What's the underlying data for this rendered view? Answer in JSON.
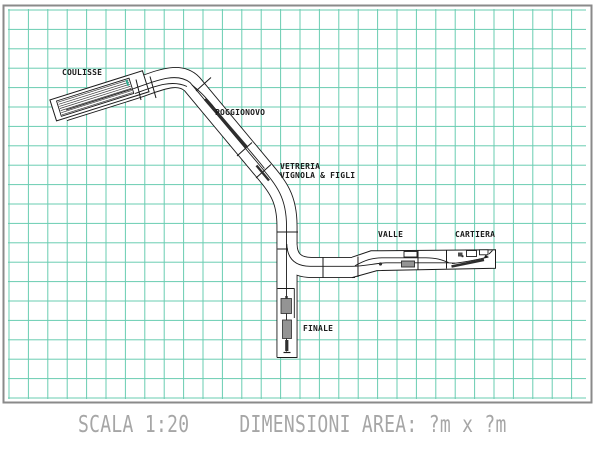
{
  "plan": {
    "type": "model-railway-track-plan",
    "scale": "1:20",
    "stations": {
      "coulisse": "COULISSE",
      "poggionovo": "POGGIONOVO",
      "vetreria_line1": "VETRERIA",
      "vetreria_line2": "VIGNOLA & FIGLI",
      "valle": "VALLE",
      "cartiera": "CARTIERA",
      "finale": "FINALE"
    },
    "caption": {
      "scale_label": "SCALA 1:20",
      "area_label": "DIMENSIONI AREA: ?m x ?m"
    }
  },
  "colors": {
    "paper": "#ffffff",
    "grid": "#4fc3a4",
    "frame": "#8a8a8a",
    "ink": "#1a1a1a",
    "caption": "#a6a6a6",
    "building": "#949494",
    "accent": "#2fae92"
  }
}
